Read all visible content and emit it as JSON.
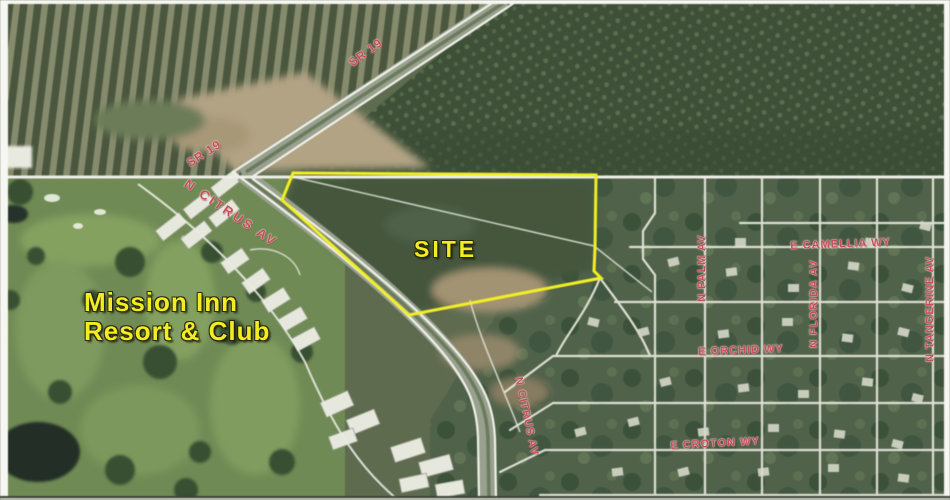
{
  "annotations": {
    "site_label": "SITE",
    "resort_label_line1": "Mission Inn",
    "resort_label_line2": "Resort & Club"
  },
  "road_labels": {
    "sr19_north": "SR 19",
    "sr19_junction": "SR 19",
    "citrus_junction": "N CITRUS AV",
    "citrus_south": "N CITRUS AV",
    "camellia": "E CAMELLIA WY",
    "palm": "N PALM AV",
    "florida": "N FLORIDA AV",
    "tangerine": "N TANGERINE AV",
    "orchid": "E ORCHID WY",
    "croton": "E CROTON WY"
  },
  "colors": {
    "annotation_yellow": "#f3ec23",
    "road_label_red": "#c84f5a",
    "site_outline": "#f2ee25"
  }
}
